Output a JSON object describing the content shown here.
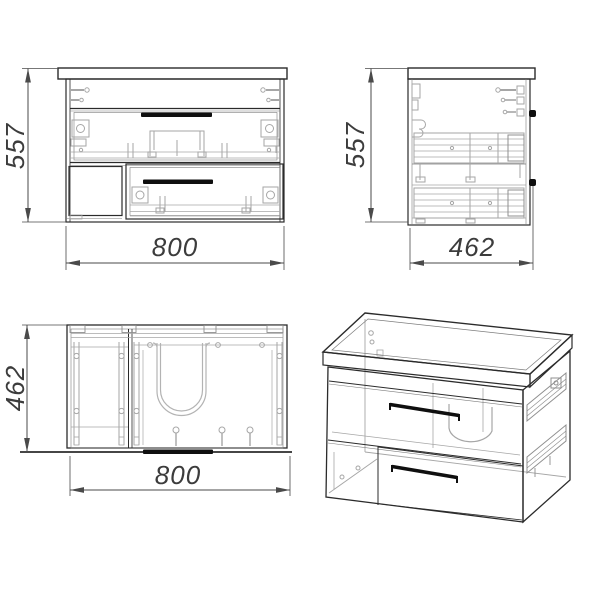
{
  "drawing": {
    "type": "furniture technical drawing",
    "subject": "wall-hung two-drawer sink vanity cabinet",
    "views": {
      "front": {
        "name": "front view",
        "height_mm": "557",
        "width_mm": "800"
      },
      "side": {
        "name": "side view",
        "height_mm": "557",
        "depth_mm": "462"
      },
      "top": {
        "name": "top view",
        "depth_mm": "462",
        "width_mm": "800"
      },
      "isometric": {
        "name": "isometric view"
      }
    },
    "colors": {
      "outline": "#2b2b2b",
      "hardware_detail": "#a6a6a6",
      "handle": "#0f0f0f",
      "dimension": "#4a4a4a",
      "background": "#ffffff"
    }
  }
}
